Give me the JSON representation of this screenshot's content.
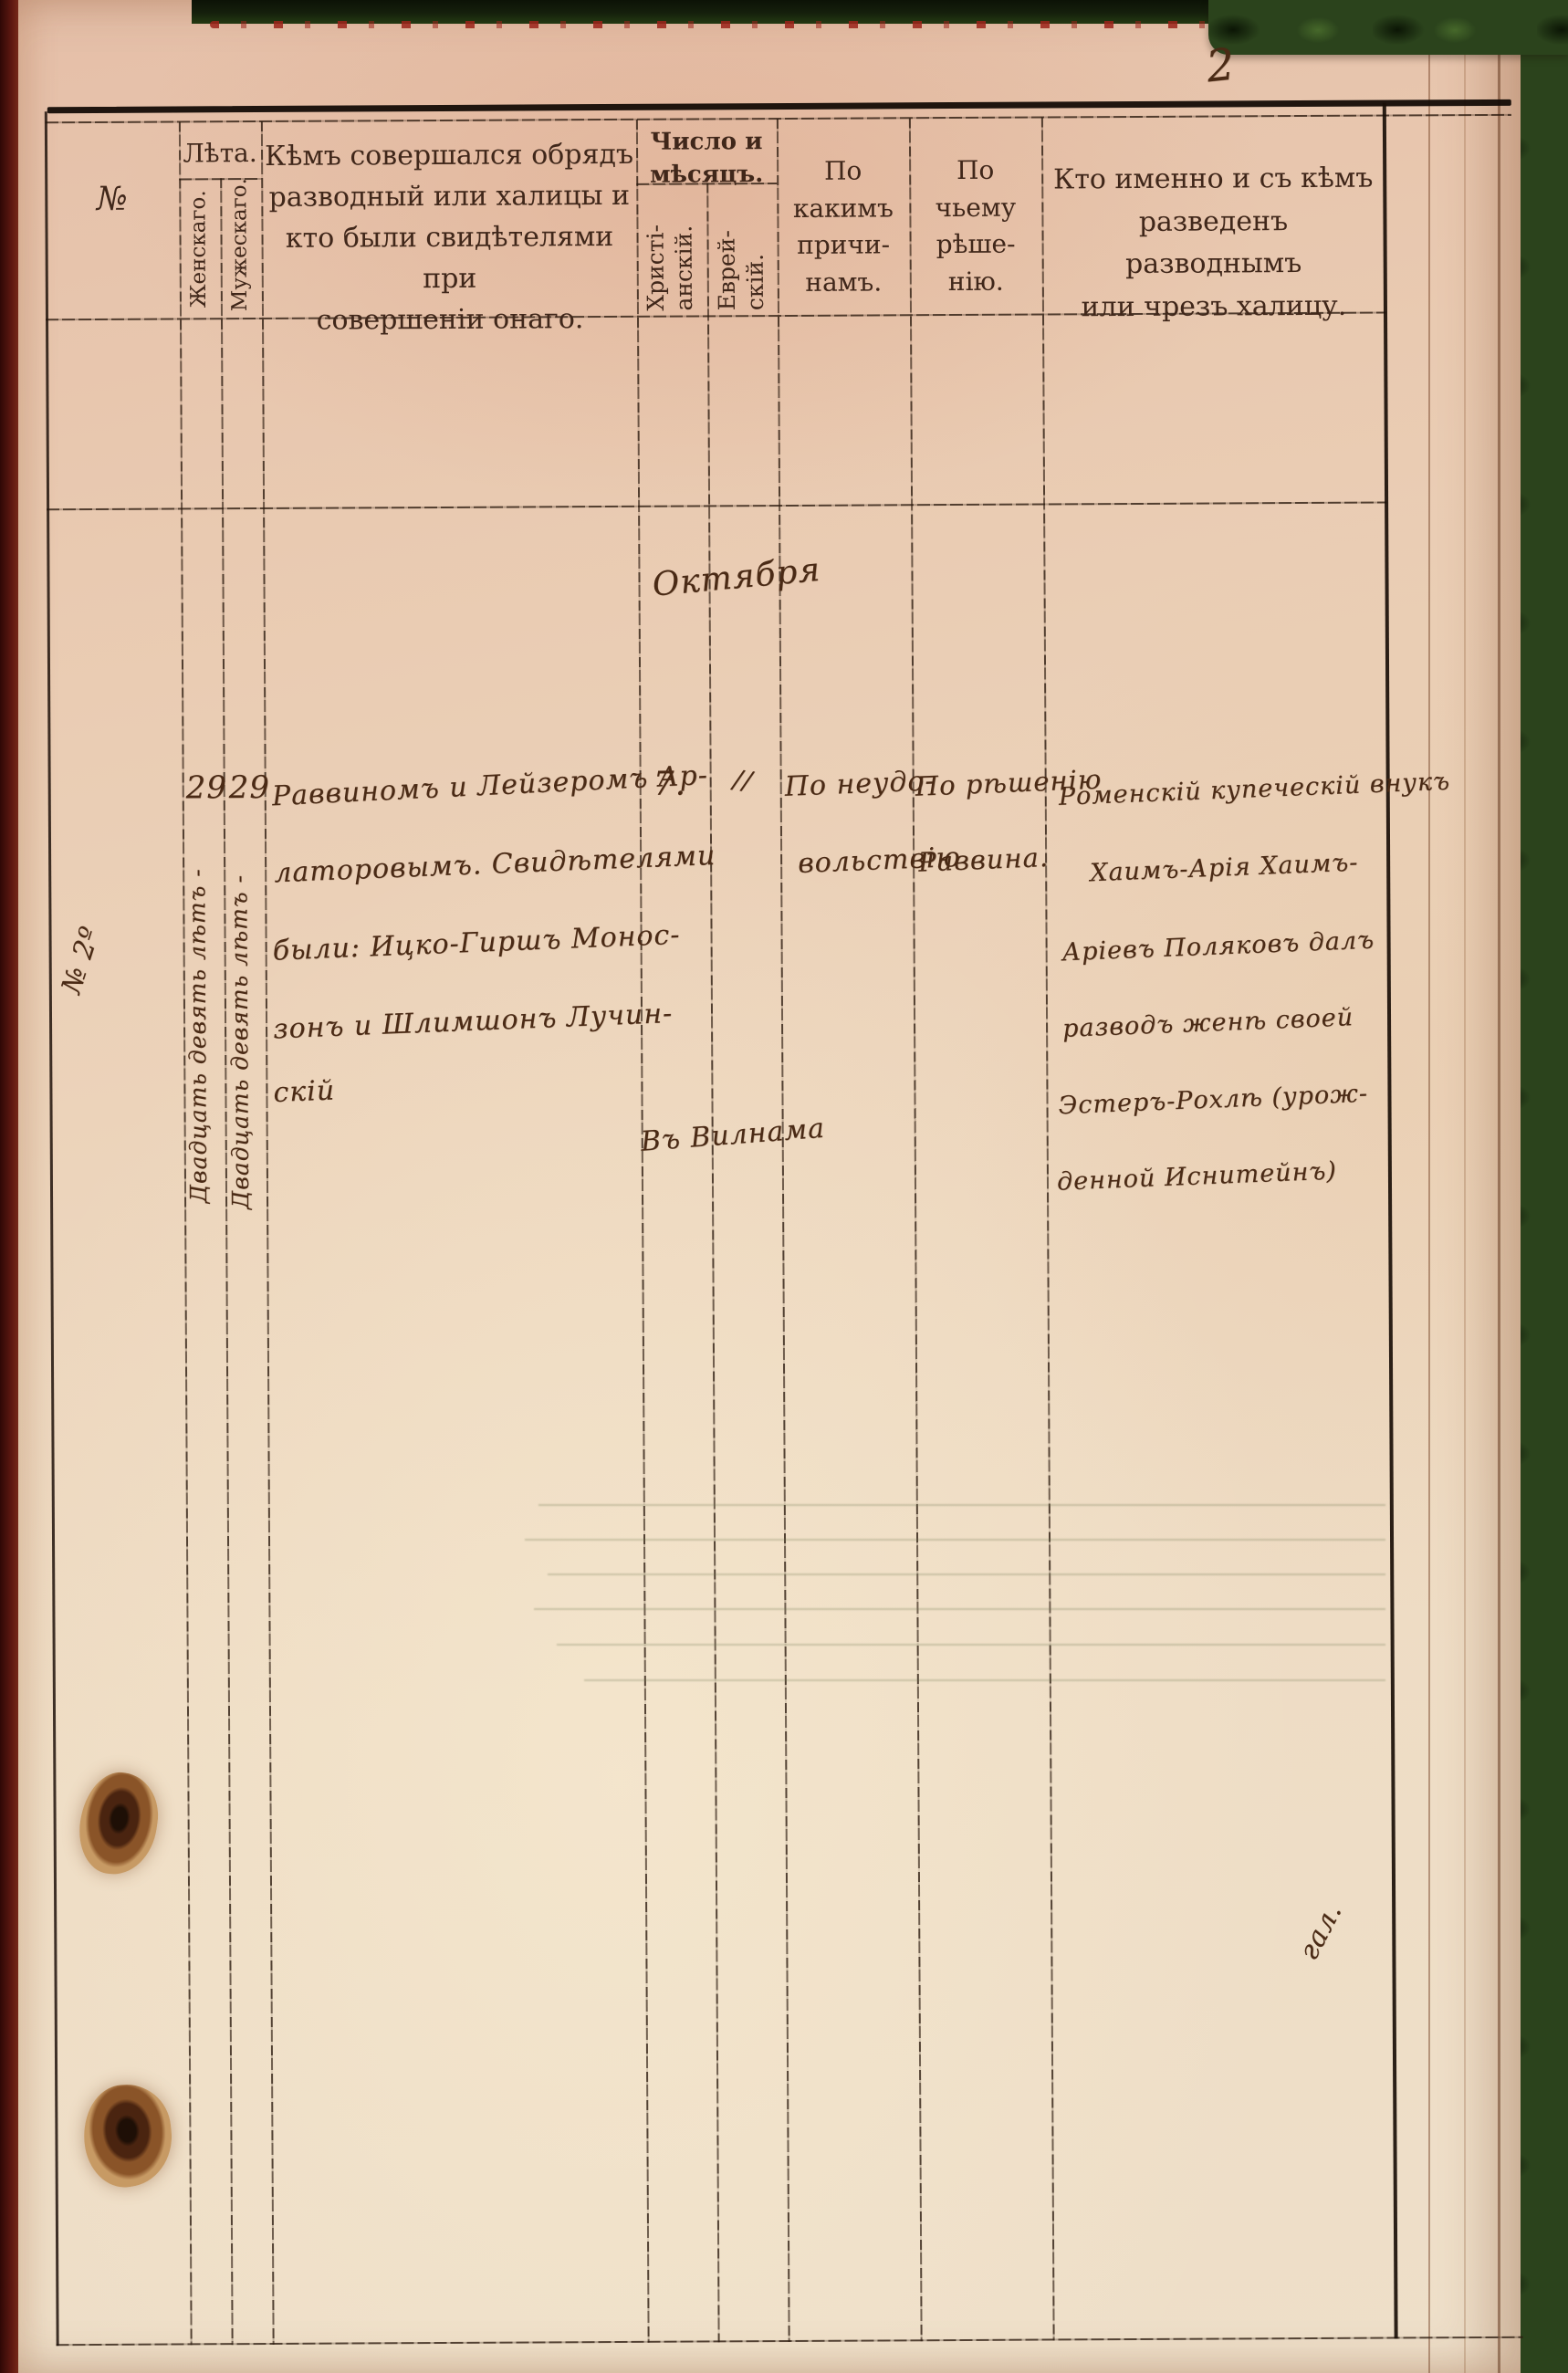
{
  "page": {
    "number": "2"
  },
  "table": {
    "headers": {
      "no": "№",
      "years_title": "Лѣта.",
      "years_female": "Женскаго.",
      "years_male": "Мужескаго.",
      "officiant_lines": [
        "Кѣмъ совершался обрядъ",
        "разводный или халицы и",
        "кто были свидѣтелями при",
        "совершеніи онаго."
      ],
      "date_title_lines": [
        "Число и",
        "мѣсяцъ."
      ],
      "date_christian_lines": [
        "Христі-",
        "анскій."
      ],
      "date_jewish_lines": [
        "Еврей-",
        "скій."
      ],
      "reasons_lines": [
        "По",
        "какимъ",
        "причи-",
        "намъ."
      ],
      "decision_lines": [
        "По",
        "чьему",
        "рѣше-",
        "нію."
      ],
      "who_lines": [
        "Кто именно и съ кѣмъ",
        "разведенъ разводнымъ",
        "или чрезъ халицу."
      ]
    },
    "record": {
      "margin_note": "№ 2º",
      "month": "Октября",
      "age_female": "29",
      "age_male": "29",
      "age_female_words": "Двадцать девять лѣтъ -",
      "age_male_words": "Двадцать девять лѣтъ -",
      "officiant_lines": [
        "Раввиномъ и Лейзеромъ Ар-",
        "латоровымъ. Свидѣтелями",
        "были: Ицко-Гиршъ Монос-",
        "зонъ и Шлимшонъ Лучин-",
        "скій"
      ],
      "day_christian": "7.",
      "day_jewish": "//",
      "place_note": "Въ Вилнама",
      "reason_lines": [
        "По неудо-",
        "вольствію"
      ],
      "decision_lines": [
        "По рѣшенію",
        "Раввина."
      ],
      "who_lines": [
        "Роменскій купеческій внукъ",
        "Хаимъ-Арія Хаимъ-",
        "Аріевъ Поляковъ далъ",
        "разводъ женѣ своей",
        "Эстеръ-Рохлѣ (урож-",
        "денной Иснитейнъ)"
      ],
      "corner_scribble": "гал."
    }
  },
  "colors": {
    "paper_top": "#e5bfa8",
    "paper_bottom": "#eedfc9",
    "print_ink": "#40271a",
    "hand_ink": "#4a2a15",
    "cover_green": "#2b431c",
    "spine_red": "#5c1710",
    "rule_line": "#2b1a0e"
  }
}
